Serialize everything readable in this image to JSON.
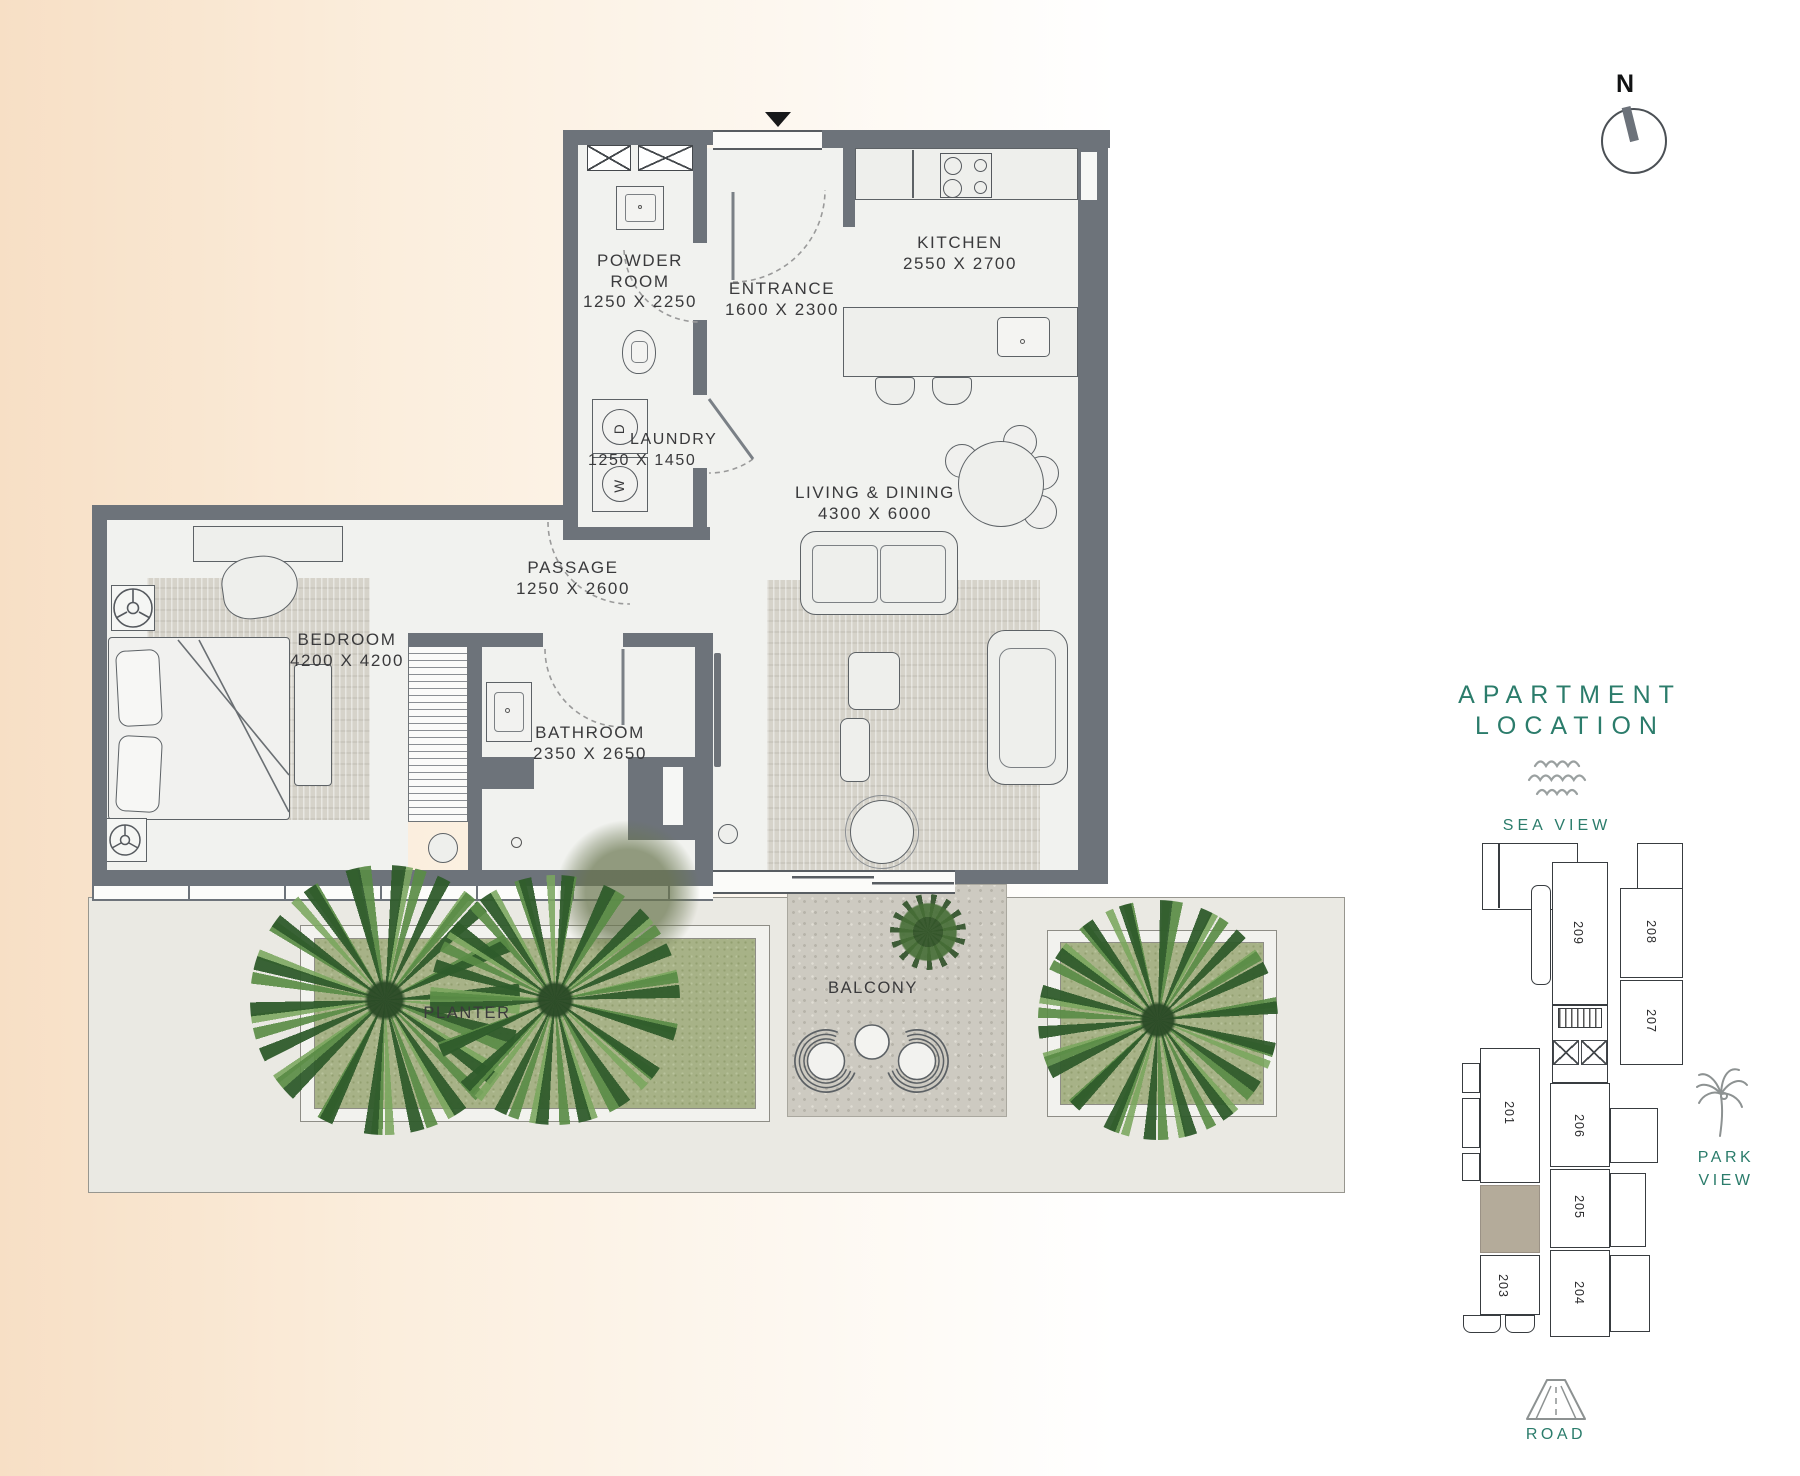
{
  "compass": {
    "north_label": "N"
  },
  "rooms": {
    "powder": {
      "lines": [
        "POWDER",
        "ROOM",
        "1250 X 2250"
      ]
    },
    "entrance": {
      "lines": [
        "ENTRANCE",
        "1600 X 2300"
      ]
    },
    "kitchen": {
      "lines": [
        "KITCHEN",
        "2550 X 2700"
      ]
    },
    "laundry": {
      "lines": [
        "LAUNDRY",
        "1250 X 1450"
      ]
    },
    "passage": {
      "lines": [
        "PASSAGE",
        "1250 X 2600"
      ]
    },
    "bedroom": {
      "lines": [
        "BEDROOM",
        "4200 X 4200"
      ]
    },
    "bathroom": {
      "lines": [
        "BATHROOM",
        "2350 X 2650"
      ]
    },
    "living": {
      "lines": [
        "LIVING & DINING",
        "4300 X 6000"
      ]
    },
    "balcony": {
      "label": "BALCONY"
    },
    "planter": {
      "label": "PLANTER"
    }
  },
  "appliances": {
    "dryer_label": "D",
    "washer_label": "W"
  },
  "location_panel": {
    "title_line1": "APARTMENT",
    "title_line2": "LOCATION",
    "sea_view_label": "SEA VIEW",
    "park_view_line1": "PARK",
    "park_view_line2": "VIEW",
    "road_label": "ROAD",
    "units": {
      "u201": "201",
      "u203": "203",
      "u204": "204",
      "u205": "205",
      "u206": "206",
      "u207": "207",
      "u208": "208",
      "u209": "209"
    },
    "colors": {
      "teal": "#2b7c6b",
      "highlight_unit": "#b4ab9a"
    }
  },
  "palette": {
    "wall": "#6d737a",
    "floor": "#f1f2ef",
    "rug": "#d6d3ca",
    "planter_green": "#a7b287",
    "gravel": "#cdcac1",
    "terrace": "#eae9e3",
    "sand": "#f7dfc5"
  }
}
